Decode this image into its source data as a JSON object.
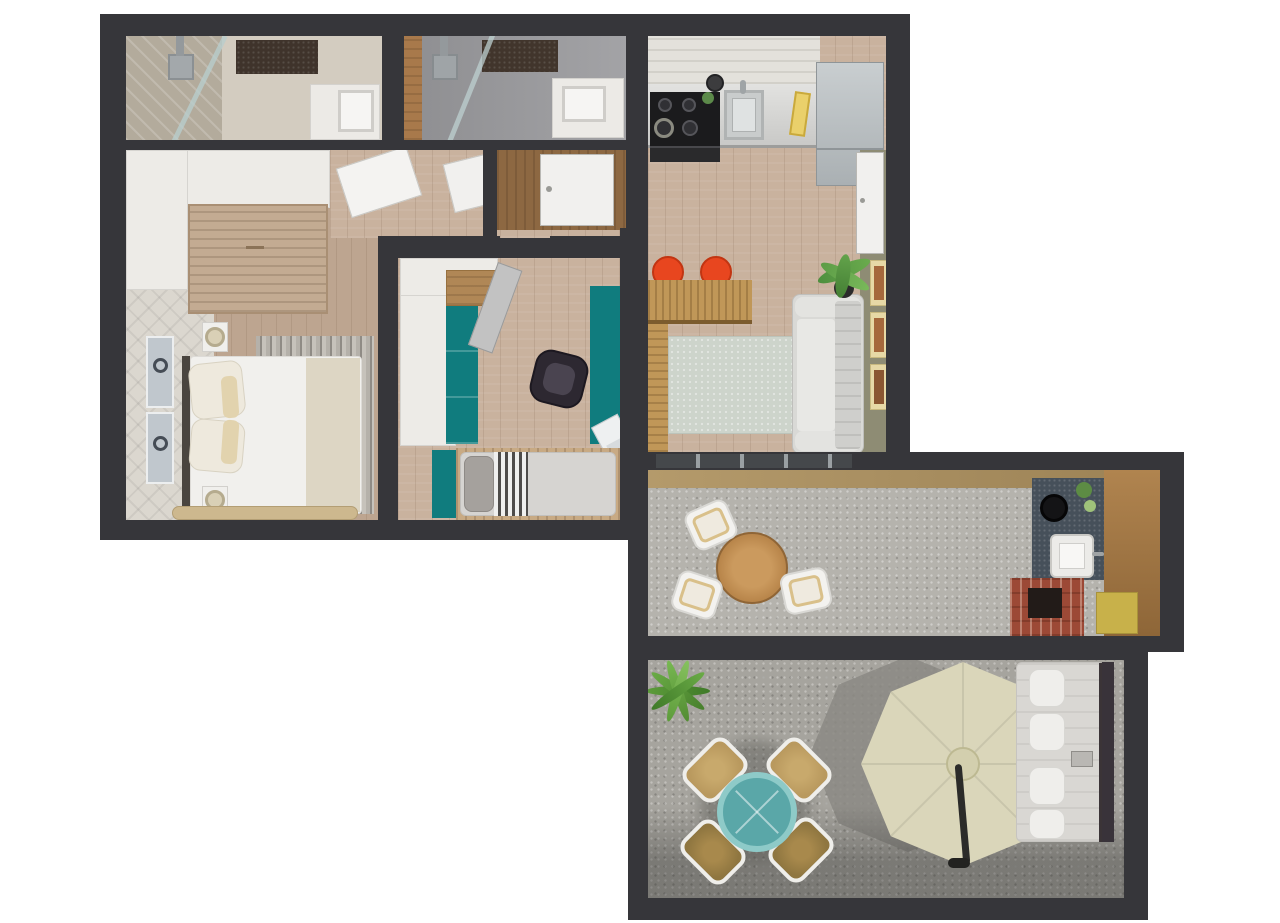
{
  "image_type": "3d-rendered-floor-plan-top-view",
  "visible_text": [],
  "colors": {
    "wall": "#36363a",
    "wood_floor": "#c9b29e",
    "wood_floor_bedroom": "#bda590",
    "teal_accent": "#107c7e",
    "orange_stool": "#e8461f",
    "olive_wall": "#8e8c74",
    "balcony_gravel": "#b5b3ad",
    "garden_gravel": "#a6a49e",
    "umbrella": "#dad6ba",
    "umbrella_shadow": "#8b8984",
    "rattan": "#b9995e",
    "teal_table": "#5aa7a8",
    "brick": "#9c4936",
    "outdoor_counter": "#46505a",
    "sofa": "#d9d9d6",
    "living_rug": "#cdd4cb",
    "wood_accent_wall": "#8d6842",
    "door_white": "#f1f0ee"
  },
  "rooms": [
    {
      "name": "bathroom-1",
      "furniture": [
        "ceiling-shower",
        "glass-partition",
        "dark-bath-mat",
        "marble-vanity-sink"
      ]
    },
    {
      "name": "bathroom-2",
      "furniture": [
        "ceiling-shower",
        "glass-partition",
        "dark-bath-mat",
        "vanity-sink",
        "wood-accent-strip"
      ]
    },
    {
      "name": "kitchen-living-room",
      "furniture": [
        "brick-backsplash",
        "gas-hob",
        "oven",
        "kitchen-sink",
        "cutting-board",
        "pot",
        "fridge",
        "bar-counter",
        "orange-stool",
        "orange-stool",
        "area-rug",
        "sofa",
        "potted-plant",
        "wall-art-x3",
        "balcony-side-door"
      ]
    },
    {
      "name": "hallway-entry",
      "furniture": [
        "open-door-panel",
        "open-door-panel",
        "wood-accent-wall",
        "entry-door"
      ]
    },
    {
      "name": "bedroom",
      "furniture": [
        "wardrobe",
        "wood-cabinet",
        "textured-accent-wall",
        "wall-art-x2",
        "double-bed",
        "pillows",
        "nightstand-lamp",
        "nightstand-lamp",
        "striped-rug",
        "foot-bench"
      ]
    },
    {
      "name": "kids-room-office",
      "furniture": [
        "white-wardrobe",
        "wood-sideboard",
        "teal-cabinet",
        "open-door",
        "teal-desk",
        "office-chair",
        "laptop",
        "single-bed",
        "striped-blanket"
      ]
    },
    {
      "name": "balcony",
      "furniture": [
        "window-band",
        "wood-sill",
        "round-wood-table",
        "white-chair",
        "white-chair",
        "white-chair",
        "outdoor-dark-counter",
        "round-grill",
        "outdoor-sink",
        "herb-pots",
        "wood-wall-panel",
        "brick-bbq",
        "yellow-mat"
      ]
    },
    {
      "name": "garden-patio",
      "furniture": [
        "grass-plant",
        "teal-round-table",
        "rattan-chair",
        "rattan-chair",
        "rattan-chair",
        "rattan-chair",
        "parasol-umbrella",
        "umbrella-arm",
        "double-sun-lounger",
        "lounger-pillows-x4"
      ]
    }
  ]
}
